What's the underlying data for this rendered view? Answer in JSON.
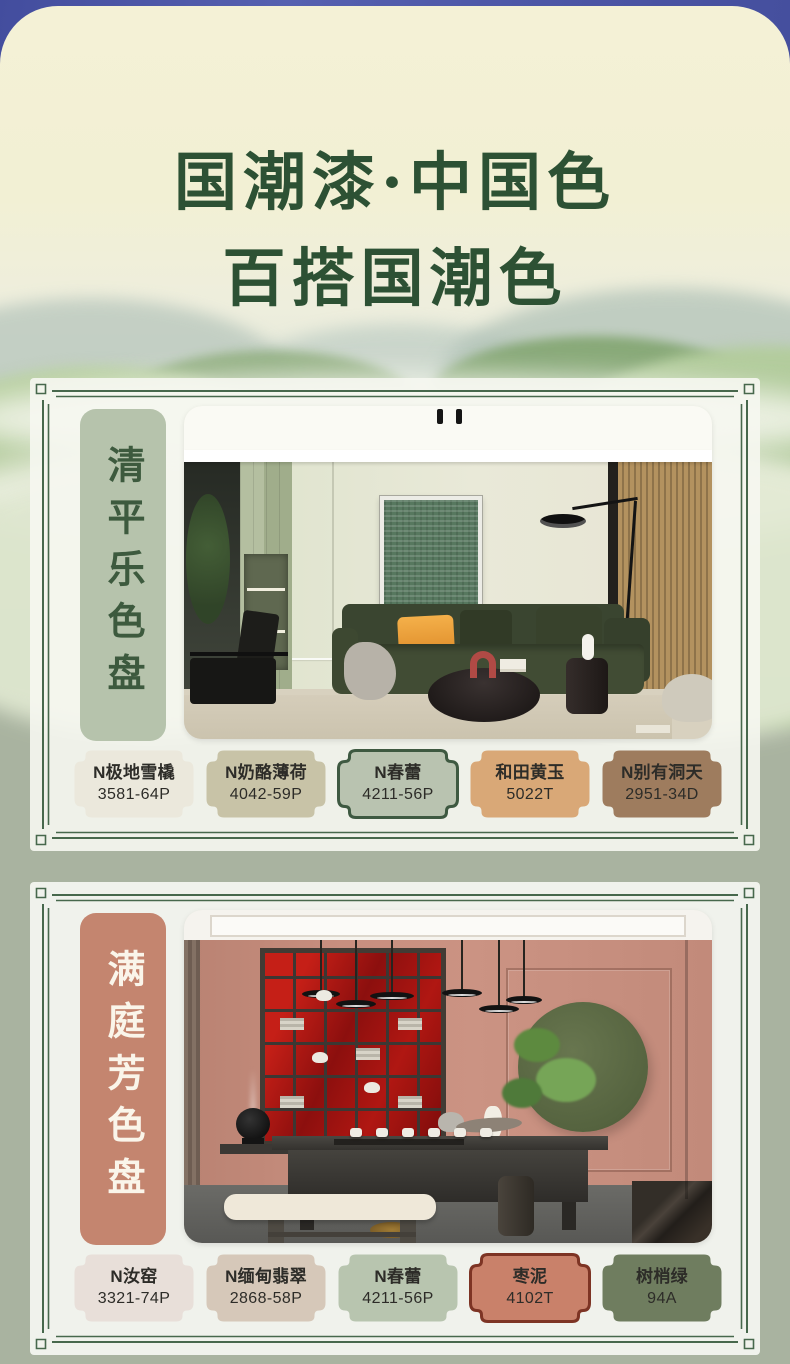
{
  "poster": {
    "title": {
      "line1": "国潮漆·中国色",
      "line2": "百搭国潮色",
      "color": "#2d5134"
    },
    "colors": {
      "top_background": "#4a54a4",
      "panel_cream": "#f2f0d4",
      "base_sage": "#a9b3a0",
      "frame_green": "#47684c",
      "card_white": "#f4f5ef"
    }
  },
  "cards": [
    {
      "label": "清平乐色盘",
      "label_bg": "#b6c3ac",
      "label_color": "#3d5a3e",
      "swatches": [
        {
          "name": "N极地雪橇",
          "code": "3581-64P",
          "color": "#ebe8dc",
          "border": "none"
        },
        {
          "name": "N奶酪薄荷",
          "code": "4042-59P",
          "color": "#c8c3a7",
          "border": "none"
        },
        {
          "name": "N春蕾",
          "code": "4211-56P",
          "color": "#b9c3b0",
          "border": "#3e5941"
        },
        {
          "name": "和田黄玉",
          "code": "5022T",
          "color": "#d9a877",
          "border": "none"
        },
        {
          "name": "N别有洞天",
          "code": "2951-34D",
          "color": "#9e7c5e",
          "border": "none"
        }
      ]
    },
    {
      "label": "满庭芳色盘",
      "label_bg": "#c4856f",
      "label_color": "#faf5ea",
      "swatches": [
        {
          "name": "N汝窑",
          "code": "3321-74P",
          "color": "#e8dfd9",
          "border": "none"
        },
        {
          "name": "N缅甸翡翠",
          "code": "2868-58P",
          "color": "#d6c8b9",
          "border": "none"
        },
        {
          "name": "N春蕾",
          "code": "4211-56P",
          "color": "#b8c5af",
          "border": "none"
        },
        {
          "name": "枣泥",
          "code": "4102T",
          "color": "#c9816a",
          "border": "#7d3424"
        },
        {
          "name": "树梢绿",
          "code": "94A",
          "color": "#6f7d5f",
          "border": "none"
        }
      ]
    }
  ]
}
